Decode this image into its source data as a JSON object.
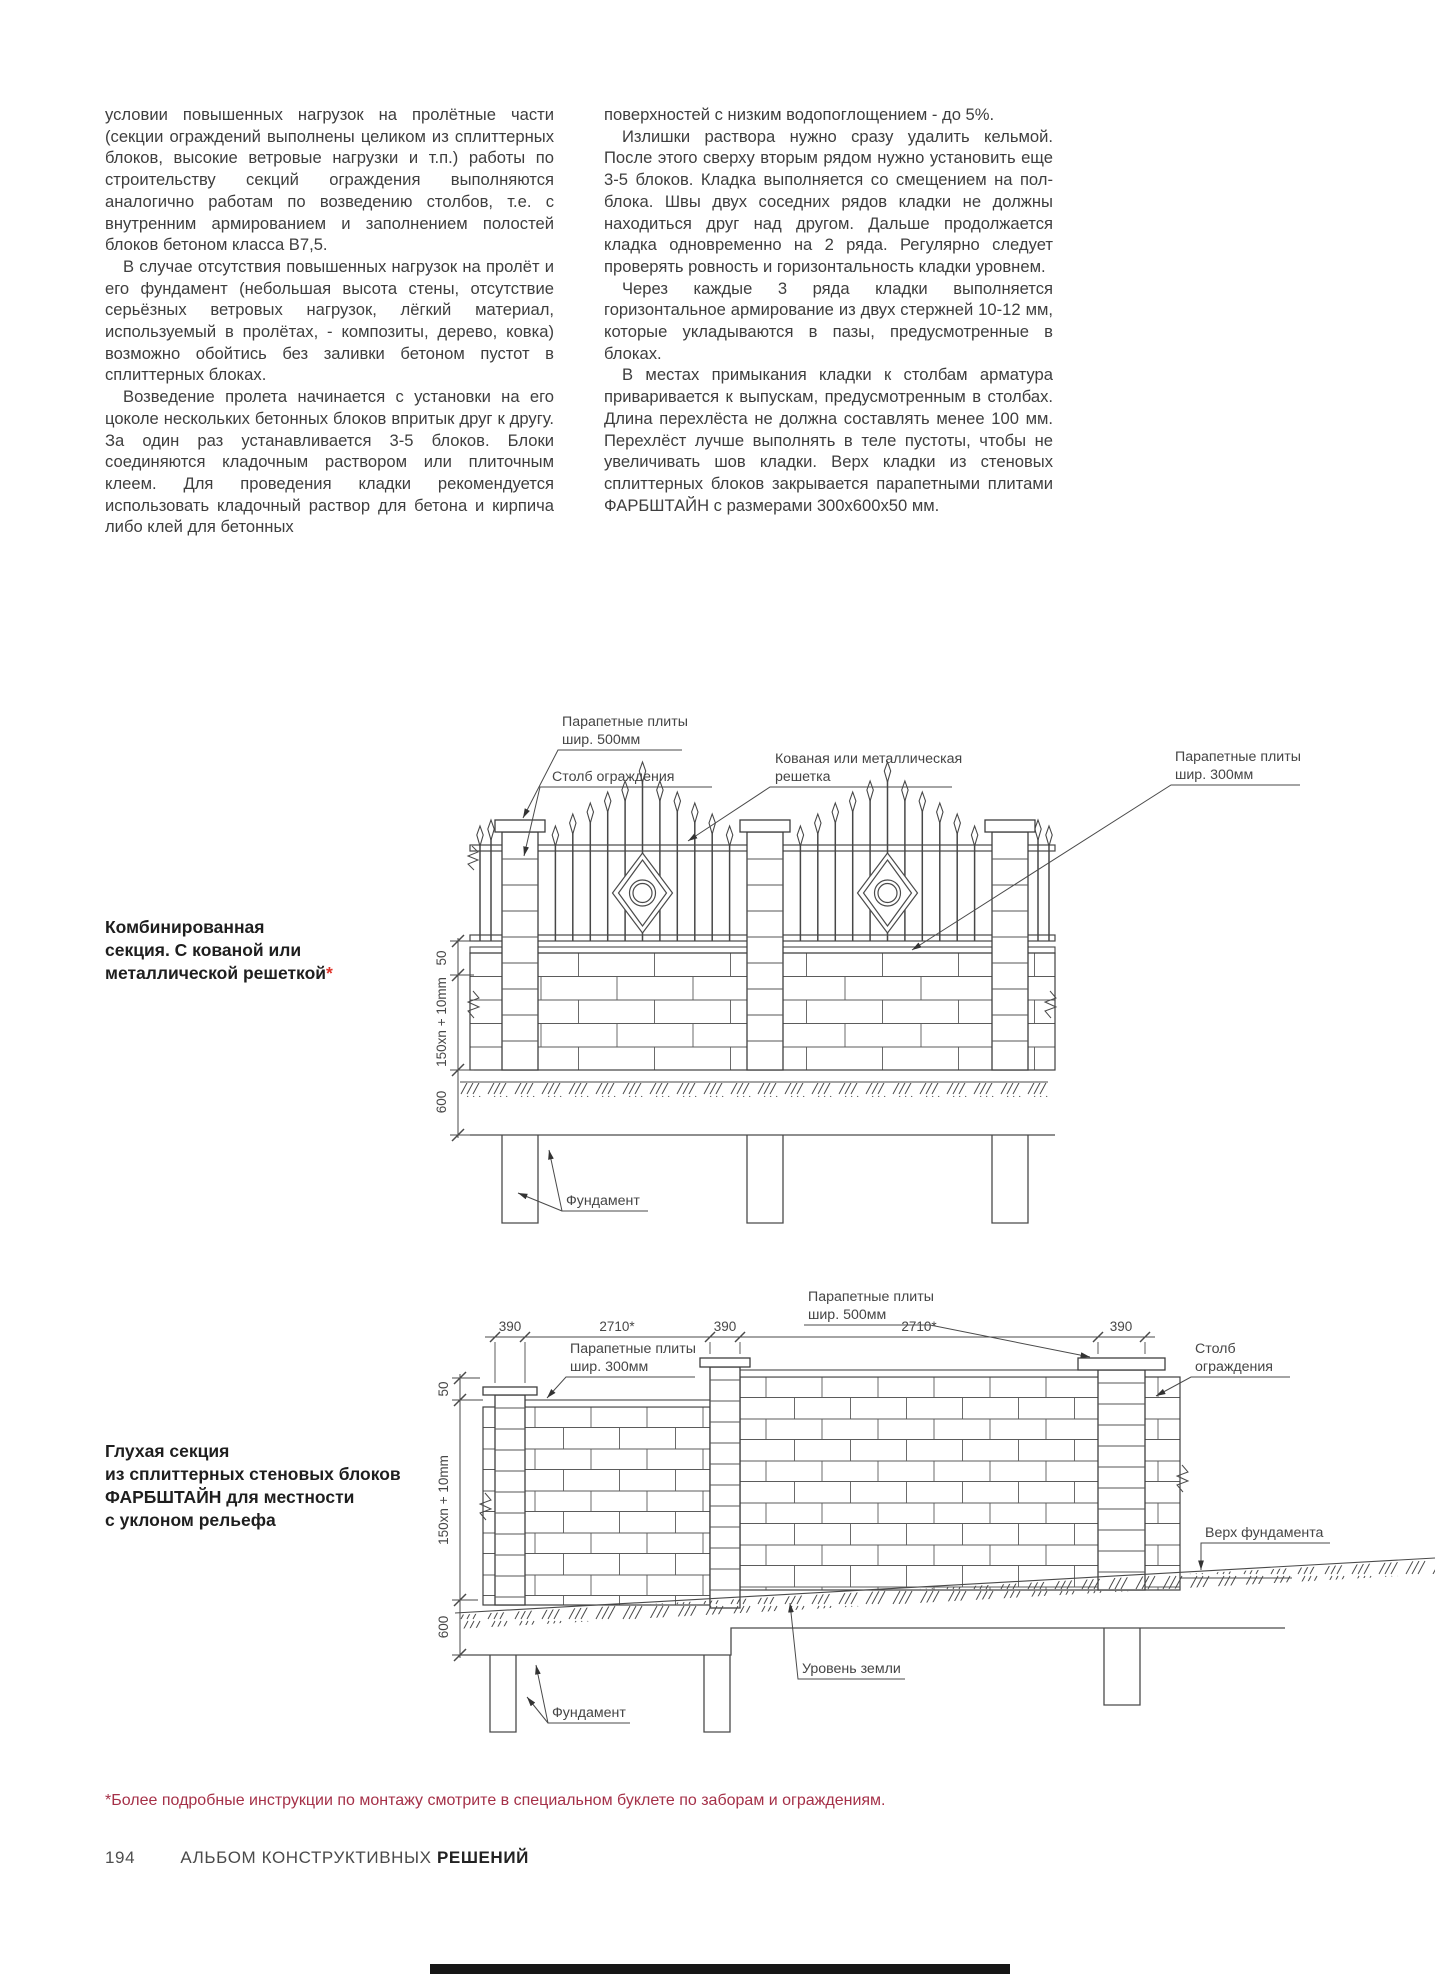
{
  "colors": {
    "asterisk_red": "#e0352b",
    "footnote_red": "#a53048",
    "ink": "#3e3e3e",
    "drawing_line": "#4a4a4a"
  },
  "columns": {
    "left": [
      "условии повышенных нагрузок на пролётные части (секции ограждений выполнены целиком из сплиттерных блоков, высокие ветровые нагрузки и т.п.) работы по строительству секций ограждения выполняются аналогично работам по возведению столбов, т.е. с внутренним армированием и заполнением полостей блоков бетоном класса В7,5.",
      "В случае отсутствия повышенных нагрузок на пролёт и его фундамент (небольшая высота стены, отсутствие серьёзных ветровых нагрузок, лёгкий материал, используемый в пролётах, - композиты, дерево, ковка) возможно обойтись без заливки бетоном пустот в сплиттерных блоках.",
      "Возведение пролета начинается с установки на его цоколе нескольких бетонных блоков впритык друг к другу. За один раз устанавливается 3-5 блоков. Блоки соединяются кладочным раствором или плиточным клеем. Для проведения кладки рекомендуется использовать кладочный раствор для бетона и кирпича либо клей для бетонных"
    ],
    "right": [
      "поверхностей с низким водопоглощением - до 5%.",
      "Излишки раствора нужно сразу удалить кельмой. После этого сверху вторым рядом нужно установить еще 3-5 блоков. Кладка выполняется со смещением на пол-блока. Швы двух соседних рядов кладки не должны находиться друг над другом. Дальше продолжается кладка одновременно на 2 ряда. Регулярно следует проверять ровность и горизонтальность кладки уровнем.",
      "Через каждые 3 ряда кладки выполняется горизонтальное армирование из двух стержней 10-12 мм, которые укладываются в пазы, предусмотренные в блоках.",
      "В местах примыкания кладки к столбам арматура приваривается к выпускам, предусмотренным в столбах. Длина перехлёста не должна составлять менее 100 мм. Перехлёст лучше выполнять в теле пустоты, чтобы не увеличивать шов кладки. Верх кладки из стеновых сплиттерных блоков закрывается парапетными плитами ФАРБШТАЙН с размерами 300х600х50 мм."
    ]
  },
  "captions": {
    "c1_line1": "Комбинированная",
    "c1_line2": "секция. С кованой или",
    "c1_line3": "металлической решеткой",
    "c1_asterisk": "*",
    "c2_line1": "Глухая секция",
    "c2_line2": "из сплиттерных стеновых блоков",
    "c2_line3": "ФАРБШТАЙН для местности",
    "c2_line4": "с уклоном рельефа"
  },
  "diagram1": {
    "label_parapet500_l1": "Парапетные плиты",
    "label_parapet500_l2": "шир. 500мм",
    "label_post": "Столб ограждения",
    "label_grate_l1": "Кованая или металлическая",
    "label_grate_l2": "решетка",
    "label_parapet300_l1": "Парапетные плиты",
    "label_parapet300_l2": "шир. 300мм",
    "label_foundation": "Фундамент",
    "dim_50": "50",
    "dim_row": "150xn + 10mm",
    "dim_600": "600"
  },
  "diagram2": {
    "label_parapet500_l1": "Парапетные плиты",
    "label_parapet500_l2": "шир. 500мм",
    "label_parapet300_l1": "Парапетные плиты",
    "label_parapet300_l2": "шир. 300мм",
    "label_post_l1": "Столб",
    "label_post_l2": "ограждения",
    "label_found_top": "Верх фундамента",
    "label_ground": "Уровень земли",
    "label_foundation": "Фундамент",
    "dim_390": "390",
    "dim_2710": "2710*",
    "dim_50": "50",
    "dim_row": "150xn + 10mm",
    "dim_600": "600"
  },
  "footnote": "*Более подробные инструкции по монтажу смотрите в специальном буклете по заборам и ограждениям.",
  "footer": {
    "page_number": "194",
    "album_regular": "АЛЬБОМ КОНСТРУКТИВНЫХ",
    "album_bold": "РЕШЕНИЙ"
  }
}
